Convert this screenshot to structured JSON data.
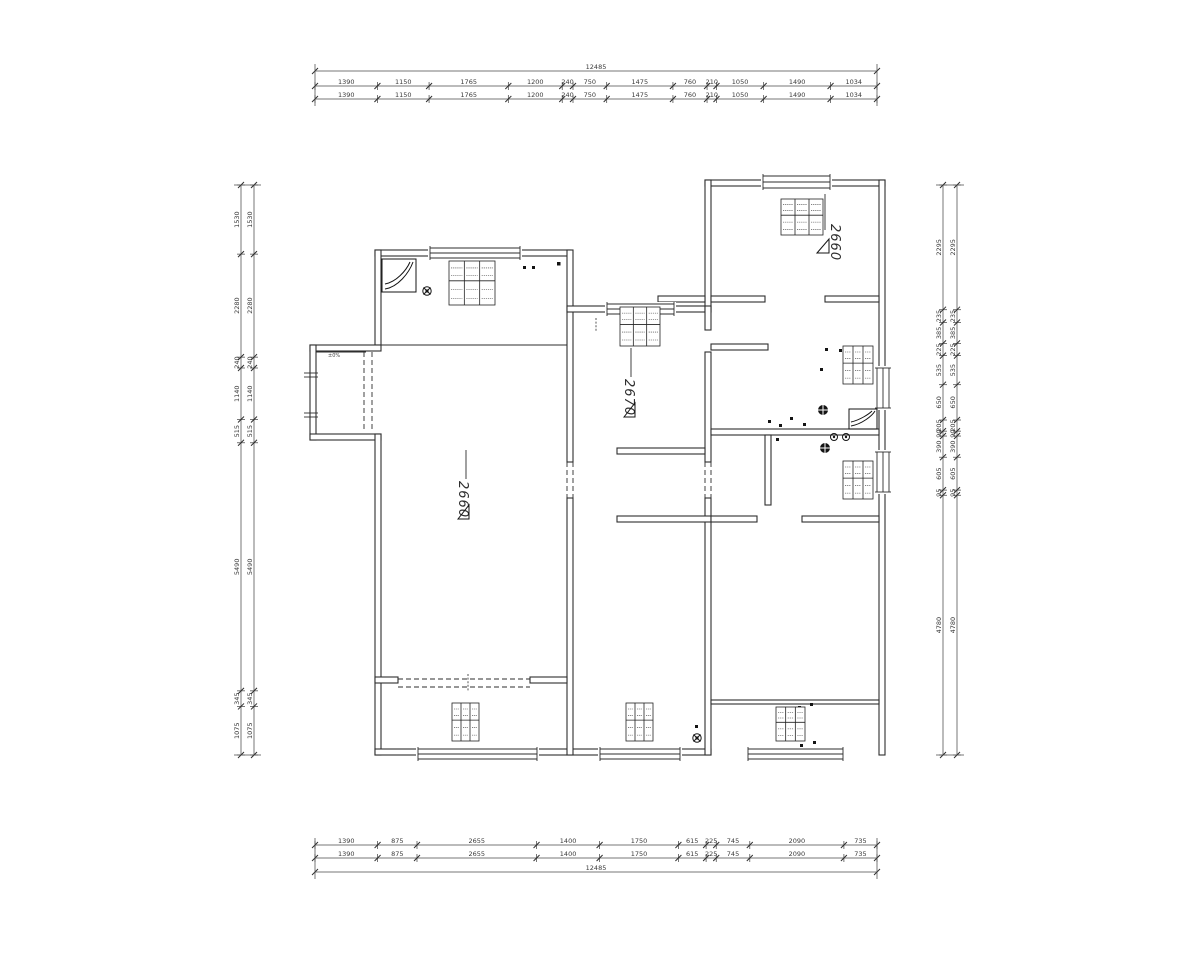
{
  "colors": {
    "line": "#2e2e2e",
    "background": "#ffffff"
  },
  "rooms": {
    "left_label": "2660",
    "middle_label": "2670",
    "top_right_label": "2660",
    "platform_note": "±0%"
  },
  "dimensions": {
    "top": {
      "total": "12485",
      "segments": [
        "1390",
        "1150",
        "1765",
        "1200",
        "240",
        "750",
        "1475",
        "760",
        "210",
        "1050",
        "1490",
        "1034"
      ]
    },
    "bottom": {
      "total": "12485",
      "segments": [
        "1390",
        "875",
        "2655",
        "1400",
        "1750",
        "615",
        "225",
        "745",
        "2090",
        "735"
      ]
    },
    "left": {
      "segments": [
        "1530",
        "2280",
        "240",
        "1140",
        "515",
        "5490",
        "345",
        "1075"
      ]
    },
    "right": {
      "segments": [
        "2295",
        "235",
        "385",
        "225",
        "535",
        "650",
        "205",
        "90",
        "390",
        "605",
        "95",
        "4780"
      ]
    }
  }
}
